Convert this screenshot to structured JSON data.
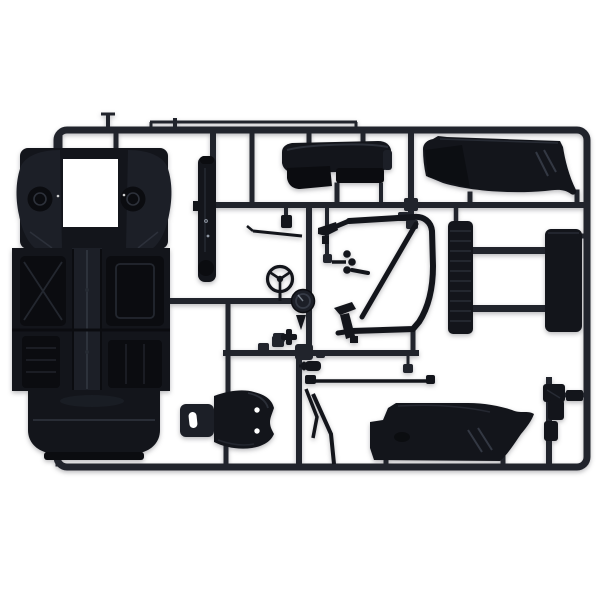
{
  "meta": {
    "description": "Product photograph of an injection-molded plastic model car kit sprue (parts runner) in black plastic on a plain white background. The rectangular runner frame holds: a large chassis floor pan with front wheel housings and an open engine-bay window, a sill/rocker strip, a dashboard, a windscreen/roll-cage frame with diagonal brace, a three-spoke steering wheel, a round gauge/drum part, a ribbed radiator core joined to a flat panel, a racing bucket seat with headrest slot, two curved body side panels, thin linkage rods and assorted small brackets.",
    "canvas": {
      "width": 600,
      "height": 600
    }
  },
  "scene": {
    "type": "product-photo",
    "subject": "black plastic model-kit parts sprue",
    "background_style": "plain white studio background, no text visible"
  },
  "colors": {
    "background": "#ffffff",
    "runner": "#21242c",
    "plastic": "#13151b",
    "plastic_dark": "#0b0c10",
    "plastic_mid": "#1c1f27",
    "plastic_light": "#272b34",
    "highlight": "#3c414d",
    "glint": "#9098a4",
    "white": "#ffffff"
  },
  "parts": [
    {
      "id": "runner-frame",
      "label": "rectangular sprue runner frame with internal runners and gate stubs"
    },
    {
      "id": "chassis-floor-pan",
      "label": "chassis floor pan with front wheel housings, shock towers and fuel-tank rear section"
    },
    {
      "id": "engine-bay-opening",
      "label": "open rectangular engine bay window in chassis front"
    },
    {
      "id": "rocker-panel",
      "label": "narrow vertical sill / rocker panel strip with rivet marks"
    },
    {
      "id": "dashboard",
      "label": "dashboard with instrument binnacle and lower lip"
    },
    {
      "id": "windscreen-frame",
      "label": "windscreen / roll-cage frame with diagonal brace"
    },
    {
      "id": "steering-wheel",
      "label": "three-spoke steering wheel"
    },
    {
      "id": "gauge-pod",
      "label": "round gauge / drum part"
    },
    {
      "id": "quarter-panel-top-right",
      "label": "curved body quarter panel, top right"
    },
    {
      "id": "radiator-core-assembly",
      "label": "ribbed radiator core joined by two bars to a flat panel"
    },
    {
      "id": "bucket-seat",
      "label": "racing bucket seat with headrest slot, lying sideways"
    },
    {
      "id": "side-panel-bottom",
      "label": "curved body side panel with flared tip, bottom center"
    },
    {
      "id": "linkage-rods",
      "label": "long thin rod, diagonal rods, cylinder and clip parts"
    },
    {
      "id": "small-brackets",
      "label": "assorted small brackets, blocks, cross piece and pronged lever"
    },
    {
      "id": "bottom-right-fittings",
      "label": "column of small fittings near bottom-right corner"
    }
  ]
}
